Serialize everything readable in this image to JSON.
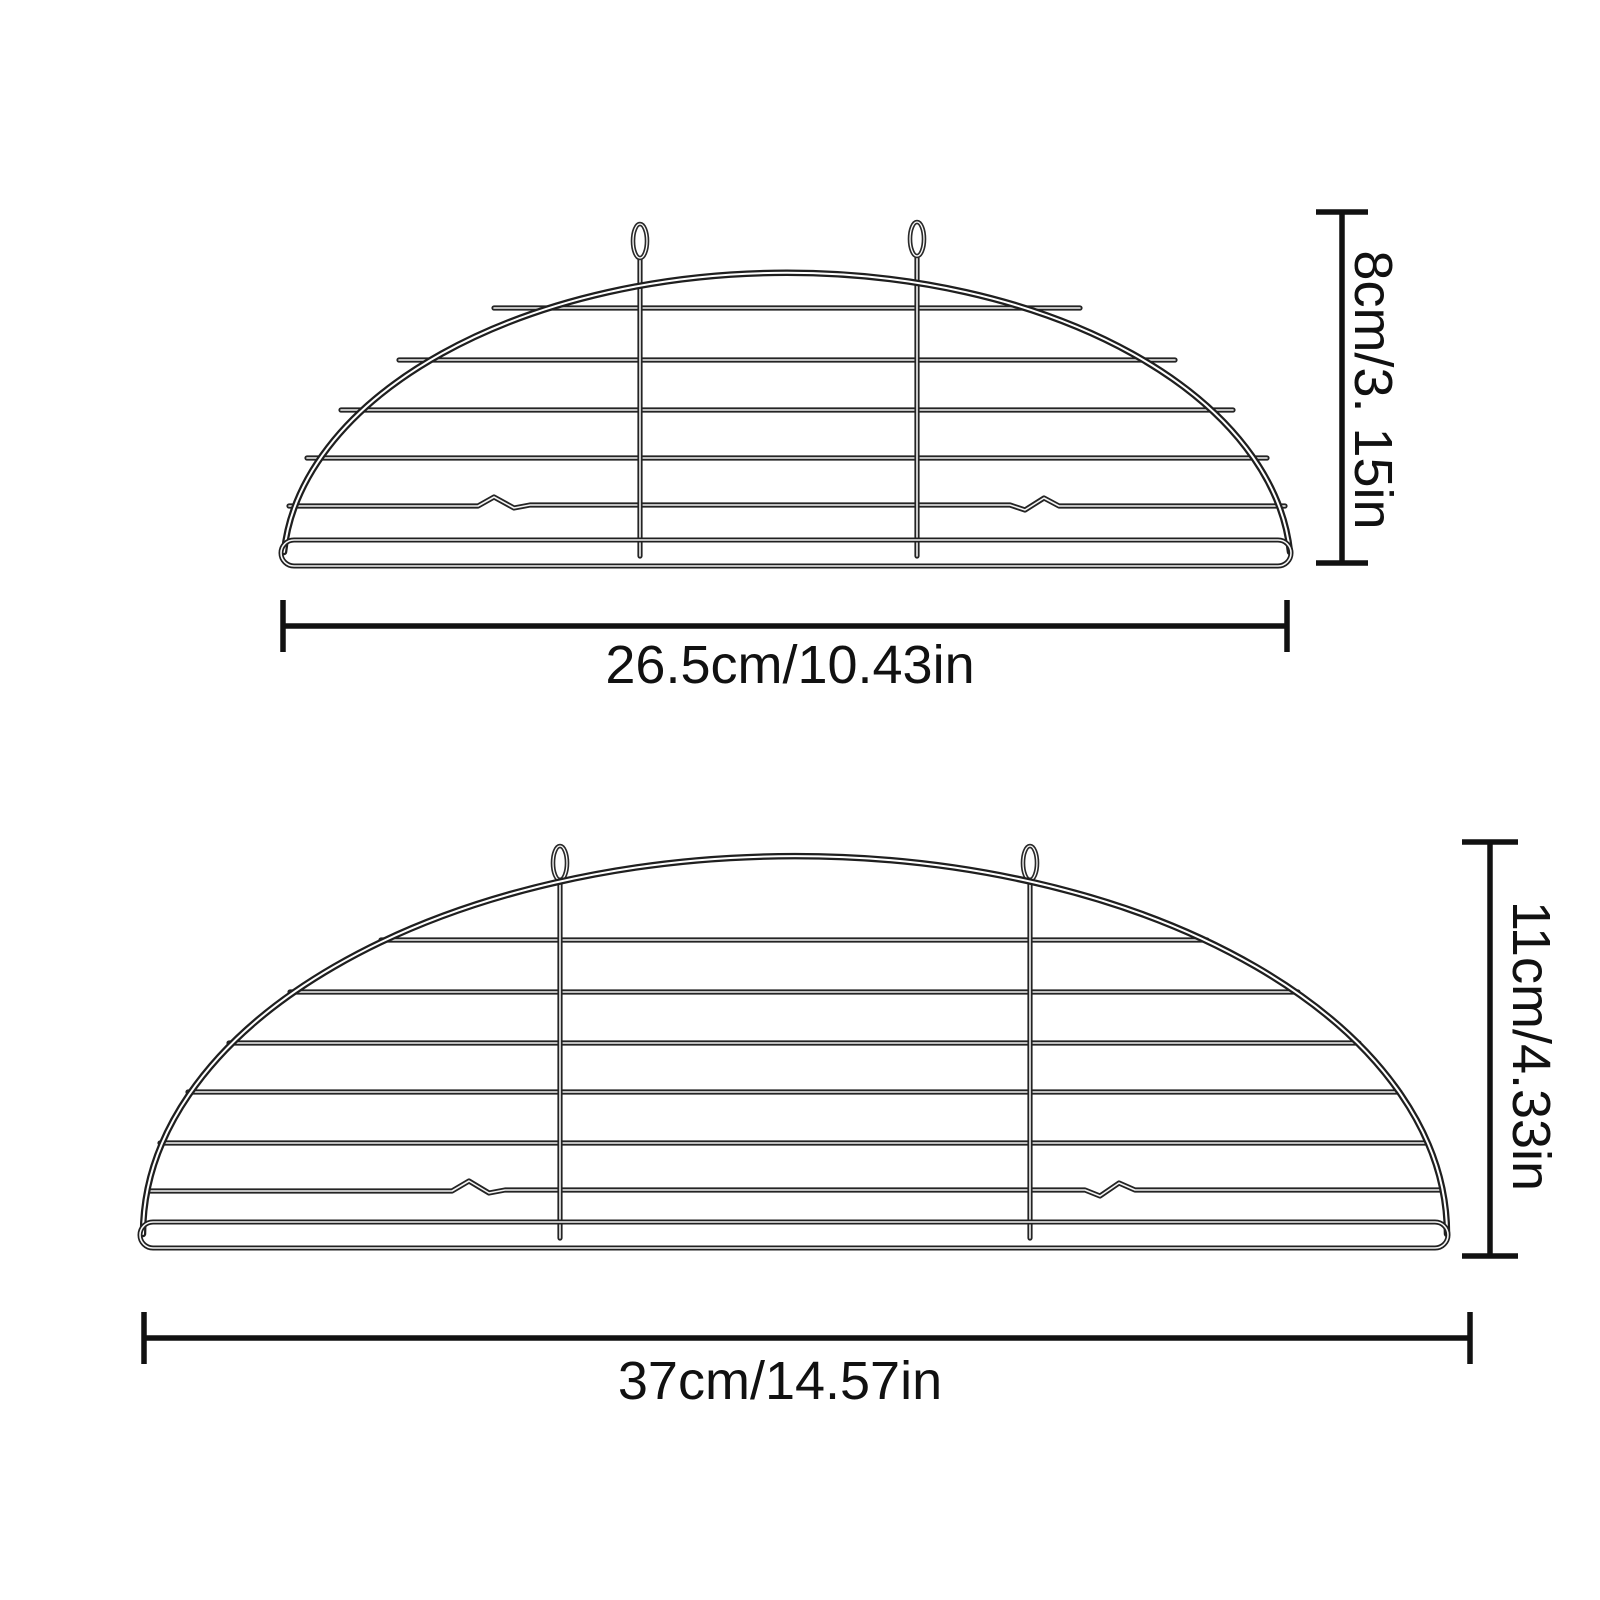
{
  "page": {
    "background_color": "#ffffff",
    "text_color": "#111111",
    "dimension_line_color": "#111111",
    "wire_dark_color": "#1f1f1f",
    "wire_highlight_color": "#ffffff"
  },
  "diagram": {
    "racks": [
      {
        "id": "small-rack",
        "width_label": "26.5cm/10.43in",
        "height_label": "8cm/3. 15in"
      },
      {
        "id": "large-rack",
        "width_label": "37cm/14.57in",
        "height_label": "11cm/4.33in"
      }
    ]
  }
}
